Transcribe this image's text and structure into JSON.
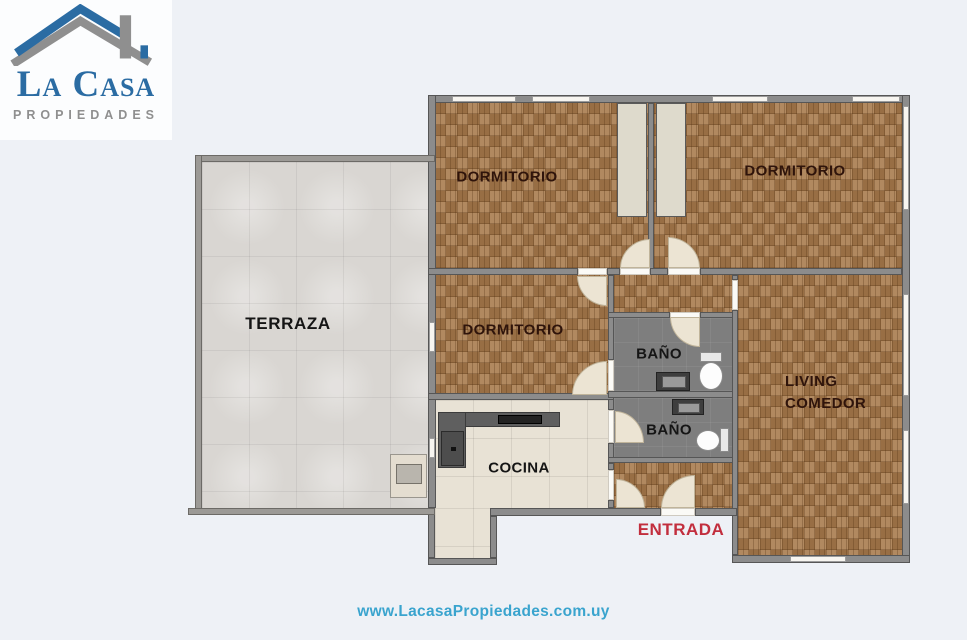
{
  "logo": {
    "title": "La Casa",
    "subtitle": "PROPIEDADES"
  },
  "rooms": {
    "dormitorio1": "DORMITORIO",
    "dormitorio2": "DORMITORIO",
    "dormitorio3": "DORMITORIO",
    "terraza": "TERRAZA",
    "bano1": "BAÑO",
    "bano2": "BAÑO",
    "cocina": "COCINA",
    "living_line1": "LIVING",
    "living_line2": "COMEDOR",
    "entrada": "ENTRADA"
  },
  "footer": {
    "url": "www.LacasaPropiedades.com.uy"
  },
  "colors": {
    "background": "#eef1f6",
    "wood_base": "#a87c4e",
    "wall": "#8c8c8c",
    "wall_edge": "#565656",
    "terrace_wall": "#9c9a96",
    "window_fill": "#f7f5f0",
    "terrace_floor": "#d9d6d2",
    "kitchen_floor": "#e8e2d5",
    "bath_floor": "#7e7e7e",
    "closet_fill": "#dedacc",
    "door_fill": "#ece4d3",
    "counter": "#5f5f5f",
    "label_dark": "#2f140b",
    "label_black": "#151515",
    "entrada_red": "#c22e3d",
    "url_blue": "#3aa4ce",
    "logo_blue": "#2b6ca3",
    "logo_gray": "#8f8f8f"
  }
}
